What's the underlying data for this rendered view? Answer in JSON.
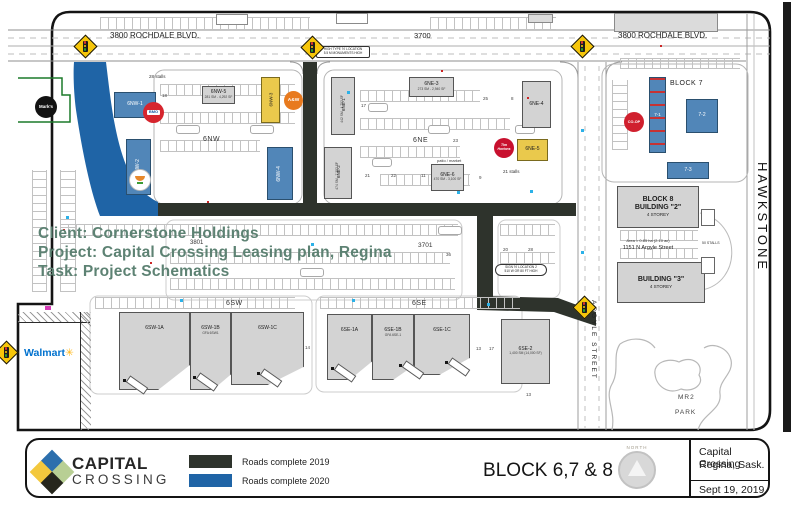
{
  "map": {
    "streets": {
      "rochdale_left": "3800 ROCHDALE BLVD.",
      "rochdale_mid": "3700",
      "rochdale_right": "3800 ROCHDALE BLVD.",
      "hawkstone": "HAWKSTONE",
      "argyle": "ARGYLE STREET",
      "addr_3801": "3801",
      "addr_3701": "3701"
    },
    "areas": {
      "nw": "6NW",
      "ne": "6NE",
      "sw": "6SW",
      "se": "6SE",
      "block7": "BLOCK 7",
      "mr2": "MR2",
      "park": "PARK"
    },
    "buildings": [
      {
        "label": "6NW-1"
      },
      {
        "label": "6NW-2"
      },
      {
        "label": "6NW-3"
      },
      {
        "label": "6NW-4"
      },
      {
        "label": "6NW-5",
        "sub": "281 SM - 4,292 SF"
      },
      {
        "label": "6NE-1",
        "sub": "442 SM - 4,752 SF"
      },
      {
        "label": "6NE-2",
        "sub": "474 SM - 7,302 SF"
      },
      {
        "label": "6NE-3",
        "sub": "273 SM - 2,940 SF"
      },
      {
        "label": "6NE-4"
      },
      {
        "label": "6NE-5"
      },
      {
        "label": "6NE-6",
        "sub": "470 SM - 3,100 SF"
      },
      {
        "label": "7-1"
      },
      {
        "label": "7-2"
      },
      {
        "label": "7-3"
      },
      {
        "label": "6SW-1A"
      },
      {
        "label": "6SW-1B",
        "sub": "GFA 6SW1"
      },
      {
        "label": "6SW-1C"
      },
      {
        "label": "6SE-1A"
      },
      {
        "label": "6SE-1B",
        "sub": "GFA 6SE-1"
      },
      {
        "label": "6SE-1C"
      },
      {
        "label": "6SE-2",
        "sub": "1,400 SM (14,000 SF)"
      }
    ],
    "block8": {
      "b2_line1": "BLOCK 8",
      "b2_line2": "BUILDING \"2\"",
      "b2_line3": "4 STOREY",
      "b3_line1": "BUILDING \"3\"",
      "b3_line2": "4 STOREY",
      "area": "Area = 0.85 ha (2.10 ac)",
      "address": "1151 N Argyle Street",
      "stalls": "50 STALLS"
    },
    "labels": {
      "stalls28": "28 stalls",
      "stalls21": "21 stalls",
      "patio": "patio / market",
      "sign_top_1": "HIGH TYPE 'N' LOCATION",
      "sign_top_2": "5.5 M MONUMENTS HIGH",
      "sign_mid_1": "SIGN 'N' LOCATION 2",
      "sign_mid_2": "510 W OR 80 FT HIGH"
    },
    "numbers": [
      "17",
      "25",
      "8",
      "23",
      "21",
      "22",
      "11",
      "9",
      "18",
      "20",
      "28",
      "36",
      "14",
      "13",
      "17",
      "13"
    ],
    "logos": {
      "marks": "Mark's",
      "bmo": "BMO",
      "aw": "A&W",
      "tim1": "Tim",
      "tim2": "Hortons",
      "coop": "CO-OP",
      "walmart": "Walmart",
      "walmart_spark": "✳"
    }
  },
  "annotation": {
    "client": "Client: Cornerstone Holdings",
    "project": "Project: Capital Crossing Leasing plan, Regina",
    "task": "Task: Project Schematics"
  },
  "footer": {
    "brand_line1": "CAPITAL",
    "brand_line2": "CROSSING",
    "legend": [
      {
        "label": "Roads complete 2019",
        "color": "#2e332c"
      },
      {
        "label": "Roads complete 2020",
        "color": "#1f64a6"
      }
    ],
    "sheet_title": "BLOCK 6,7 & 8",
    "compass_label": "NORTH",
    "info_line1": "Capital Crossing",
    "info_line2": "Regina, Sask.",
    "date": "Sept 19, 2019"
  },
  "colors": {
    "road_2019": "#2e332c",
    "road_2020": "#1f64a6",
    "building_blue": "#5186b8",
    "building_yellow": "#eac94c",
    "annotation_green": "#5d8273"
  }
}
